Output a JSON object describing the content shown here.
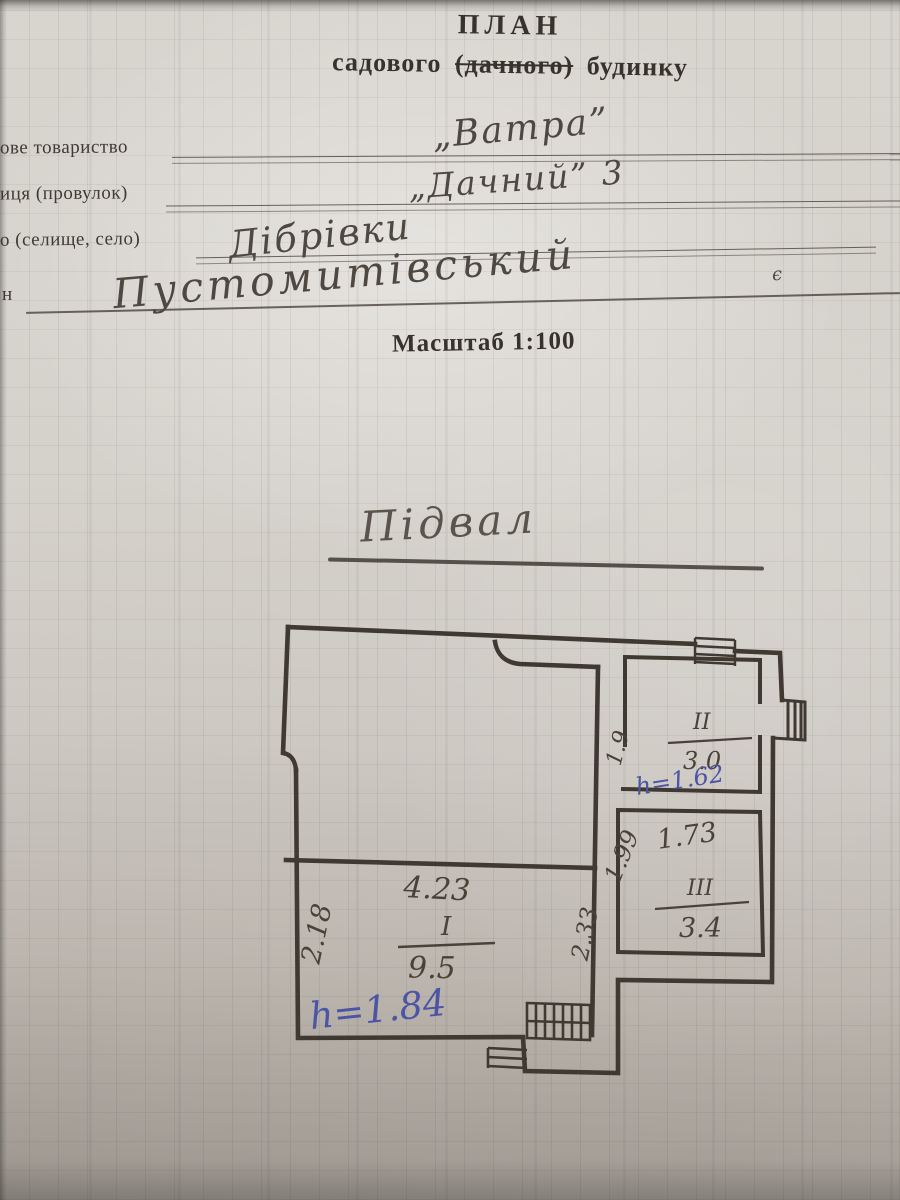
{
  "doc": {
    "title1": "ПЛАН",
    "title2_pre": "садового ",
    "title2_struck": "(дачного)",
    "title2_post": " будинку",
    "scale": "Масштаб 1:100",
    "field1_label": "ове товариство",
    "field1_value": "„Ватра”",
    "field2_label": "иця (провулок)",
    "field2_value": "„Дачний” 3",
    "field3_label": "о (селище, село)",
    "field3_value": "Дібрівки",
    "field4_label": "н",
    "field4_value": "Пустомитівський",
    "field4_mark": "є",
    "plan_caption": "Підвал"
  },
  "plan": {
    "room1": {
      "numeral": "I",
      "area": "9.5",
      "dim_top": "4.23",
      "dim_left": "2.18",
      "dim_right": "2.33",
      "height_note": "h=1.84"
    },
    "room2": {
      "numeral": "II",
      "area": "3.0",
      "dim_left": "1.9",
      "height_note": "h=1.62"
    },
    "room3": {
      "numeral": "III",
      "area": "3.4",
      "dim_top": "1.73",
      "dim_left": "1.99"
    },
    "pencil_color": "#3f3931",
    "ink_color": "#4b54a5"
  }
}
